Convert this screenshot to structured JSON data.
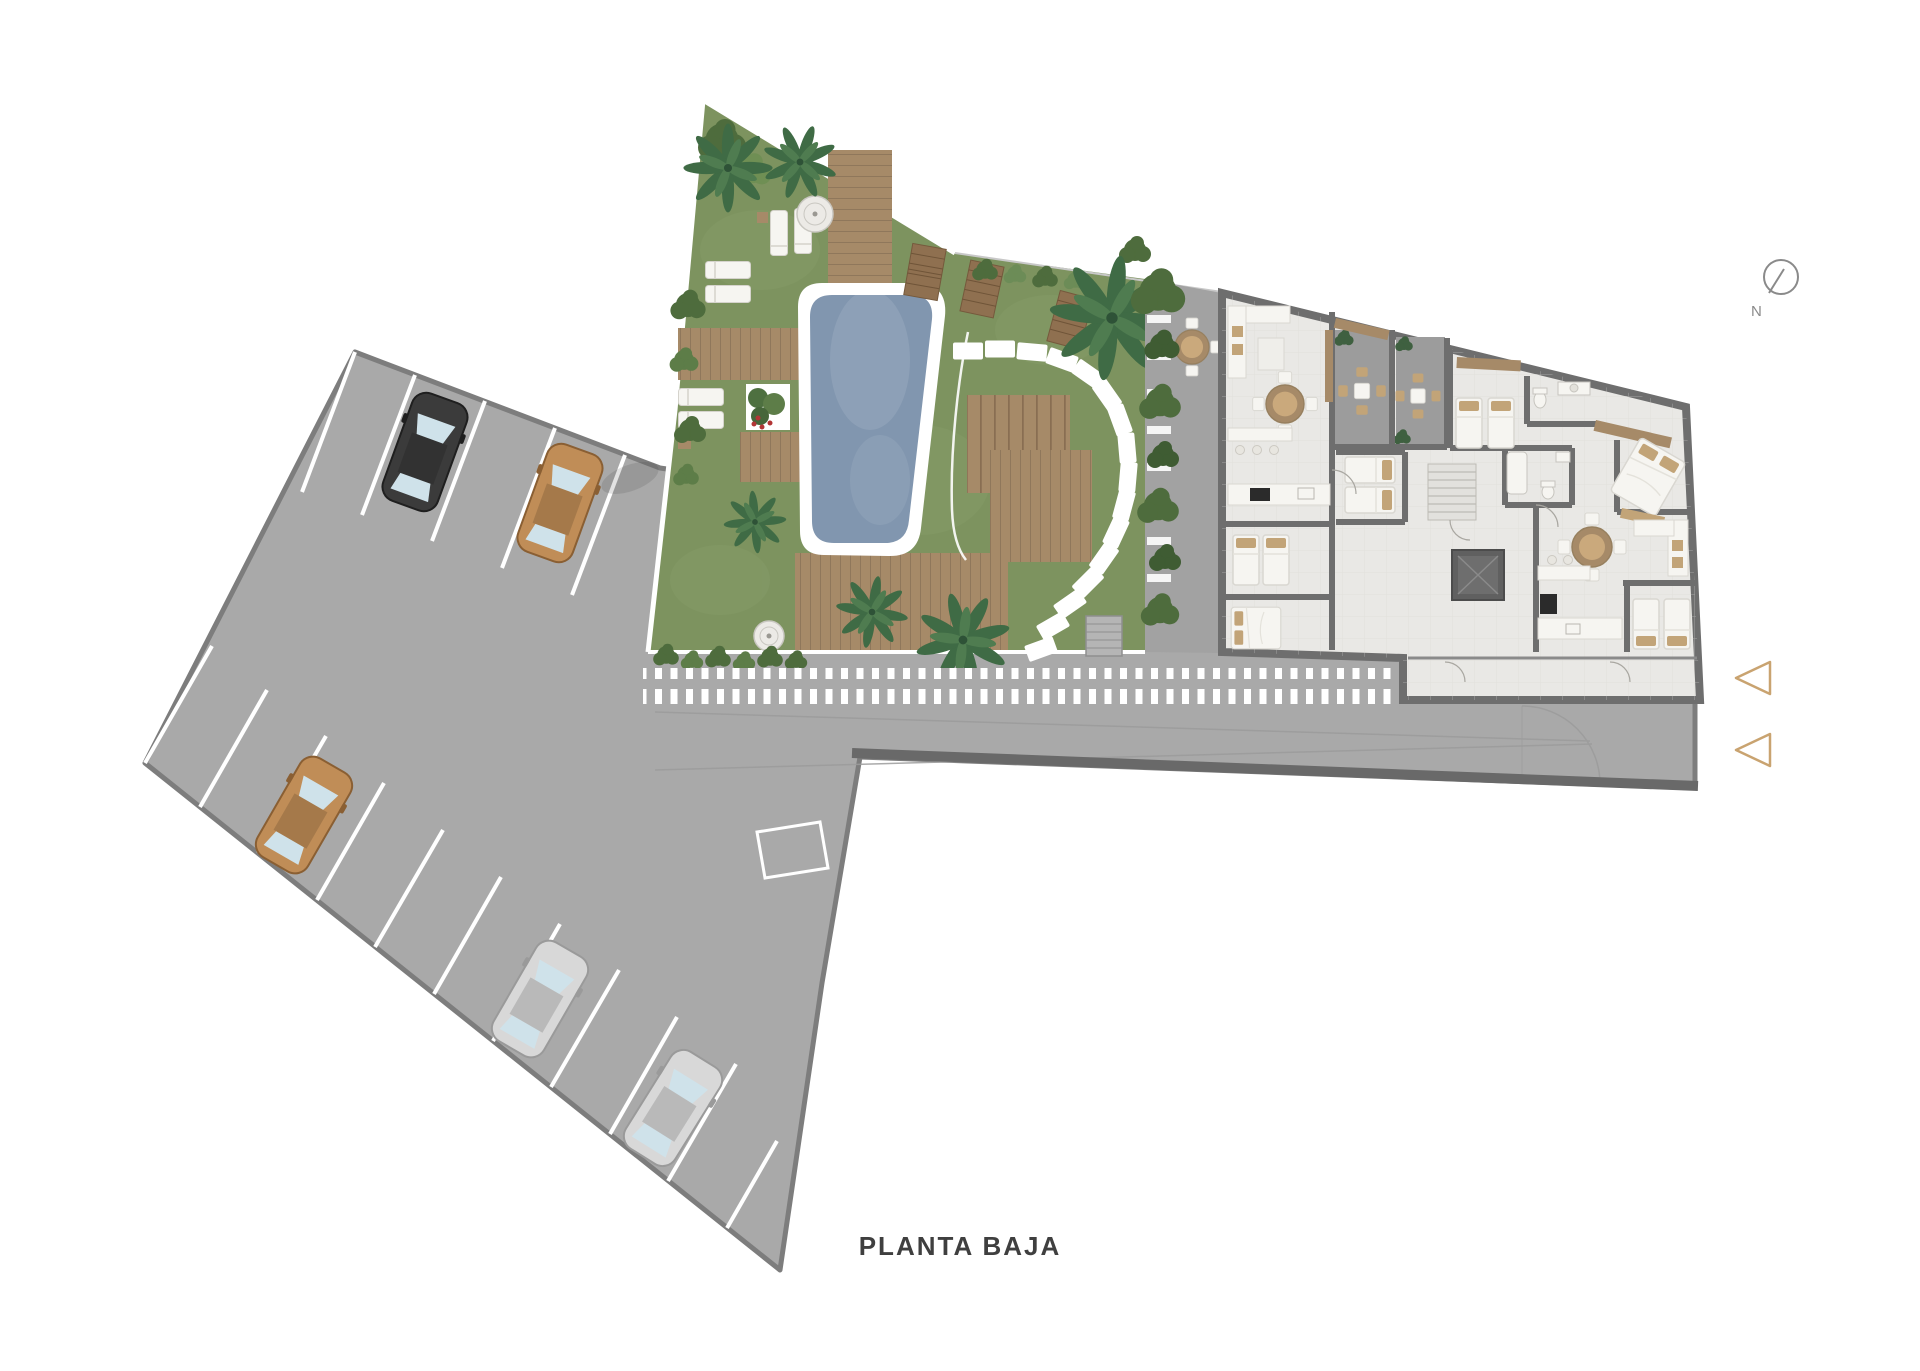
{
  "page": {
    "title": "PLANTA BAJA",
    "background": "#ffffff"
  },
  "compass": {
    "label": "N"
  },
  "entry_markers": {
    "count": 2,
    "shape": "left-pointing-triangle-outline"
  },
  "cars": [
    {
      "id": "car-1",
      "color": "dark",
      "area": "parking-top-row"
    },
    {
      "id": "car-2",
      "color": "tan",
      "area": "parking-top-row"
    },
    {
      "id": "car-3",
      "color": "tan",
      "area": "parking-bottom-row"
    },
    {
      "id": "car-4",
      "color": "silver",
      "area": "parking-bottom-row"
    },
    {
      "id": "car-5",
      "color": "silver",
      "area": "parking-bottom-row"
    }
  ],
  "areas": {
    "parking": "parking-lot",
    "garden": "landscaped-garden",
    "pool": "swimming-pool",
    "walkway": "striped-walkway",
    "terrace": "entrance-terrace",
    "building": "apartment-floor-plan",
    "road": "driveway-strip"
  },
  "colors": {
    "paving": "#a9a9a9",
    "paving_border": "#7d7d7d",
    "road_wall": "#696969",
    "grass": "#7d935f",
    "grass_light": "#8aa06e",
    "hedge": "#4e6c3d",
    "palm": "#3f6b45",
    "palm_light": "#4f7c50",
    "wood": "#a68a68",
    "wood_line": "#8f775b",
    "slat": "#7c6248",
    "pool_water": "#8196af",
    "building_floor": "#e9e8e5",
    "building_wall": "#6e6e6e",
    "patio_floor": "#9c9c9c",
    "terrace": "#a2a2a2",
    "furniture_white": "#f6f5f1",
    "furniture_stroke": "#d9d7d1",
    "pillow_tan": "#c2a478",
    "appliance_dark": "#2b2b2b",
    "car_dark": "#3b3b3b",
    "car_tan": "#c08d57",
    "car_silver": "#d8d8d8",
    "car_glass": "#cfe2ea",
    "marker_outline": "#c9a370",
    "compass_stroke": "#8a8a8a",
    "title_color": "#3f3f3f",
    "boundary_line": "#c8c8c8",
    "flower_red": "#b23535"
  }
}
